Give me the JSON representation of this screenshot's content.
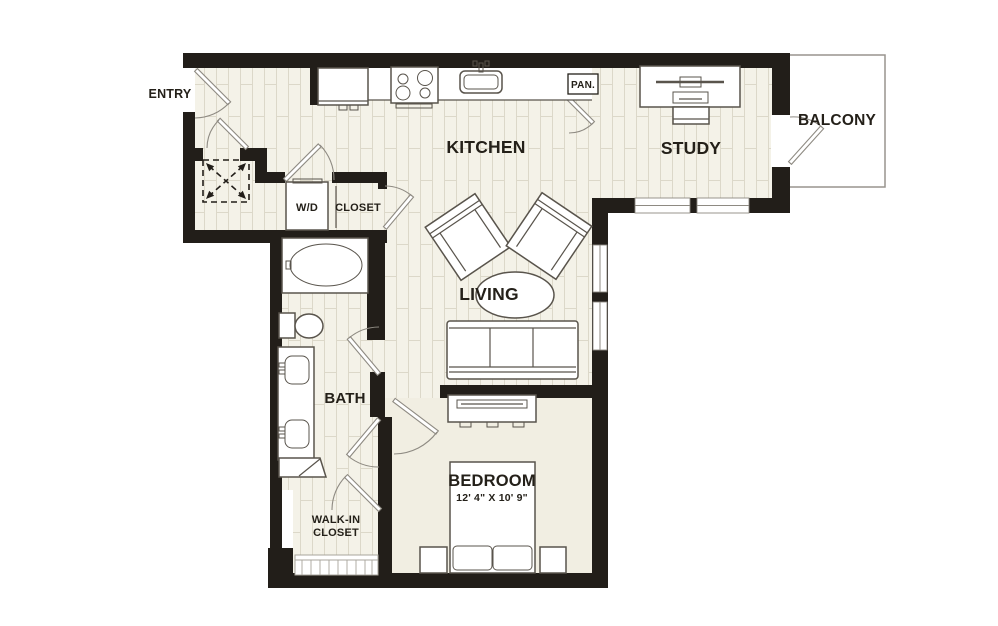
{
  "plan": {
    "type": "apartment-floor-plan",
    "labels": {
      "entry": "ENTRY",
      "kitchen": "KITCHEN",
      "pantry": "PAN.",
      "study": "STUDY",
      "balcony": "BALCONY",
      "washer_dryer": "W/D",
      "closet": "CLOSET",
      "living": "LIVING",
      "bath": "BATH",
      "walk_in_line1": "WALK-IN",
      "walk_in_line2": "CLOSET",
      "bedroom": "BEDROOM",
      "bedroom_dimensions": "12' 4\" X 10' 9\""
    },
    "colors": {
      "background": "#ffffff",
      "wall": "#221e19",
      "plank_floor": "#f4f2e8",
      "plank_line": "#dcd8c9",
      "bedroom_floor": "#f1eee2",
      "fixture_stroke": "#59544c",
      "door_line": "#8e8a82",
      "label_text": "#242019",
      "balcony_border": "#98948e"
    }
  }
}
